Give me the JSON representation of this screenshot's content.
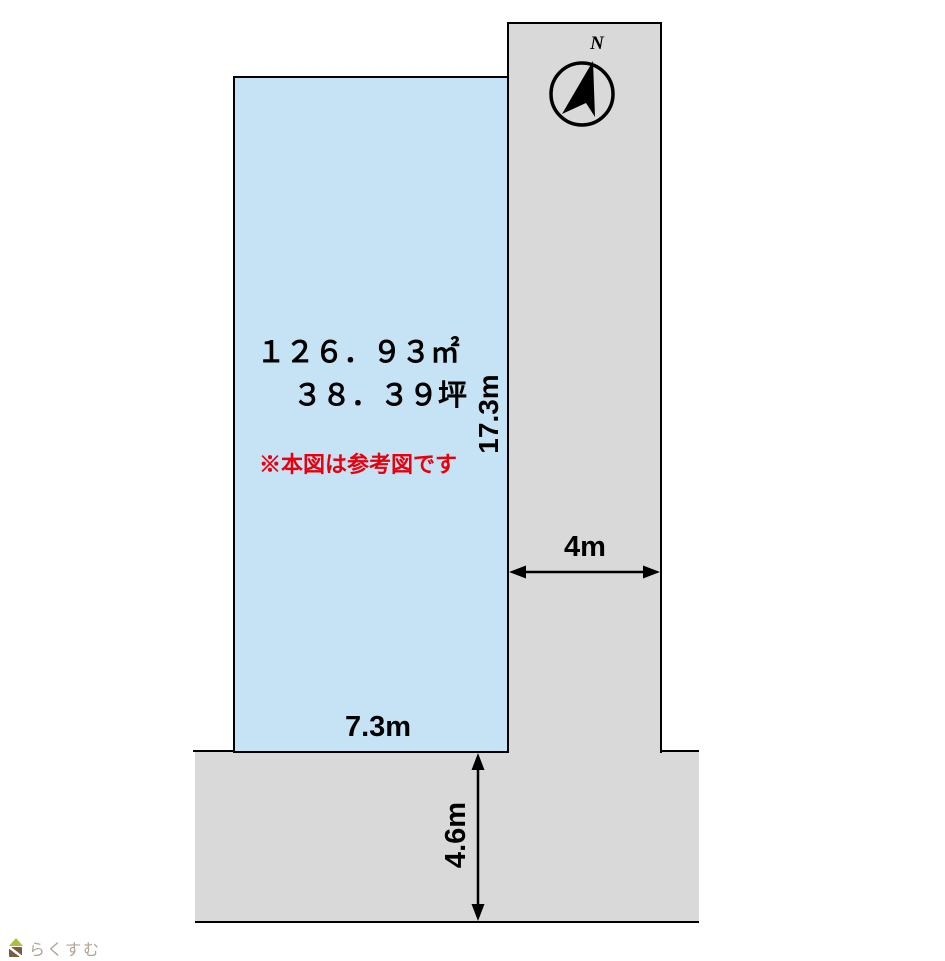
{
  "plot": {
    "area_sqm": "１２６．９３㎡",
    "area_tsubo": "３８．３９坪",
    "reference_note": "※本図は参考図です",
    "frontage_width": "7.3m",
    "depth": "17.3m",
    "fill_color": "#c5e3f5"
  },
  "roads": {
    "east_road_width": "4m",
    "south_road_width": "4.6m",
    "fill_color": "#d9d9d9"
  },
  "compass": {
    "north_label": "N"
  },
  "watermark": {
    "logo_text": "らくすむ"
  },
  "colors": {
    "outline": "#000000",
    "note_text": "#e8000d",
    "dimension_text": "#000000",
    "logo_text": "#b2a496",
    "logo_roof": "#a9c23c",
    "logo_body": "#7a5a40"
  }
}
